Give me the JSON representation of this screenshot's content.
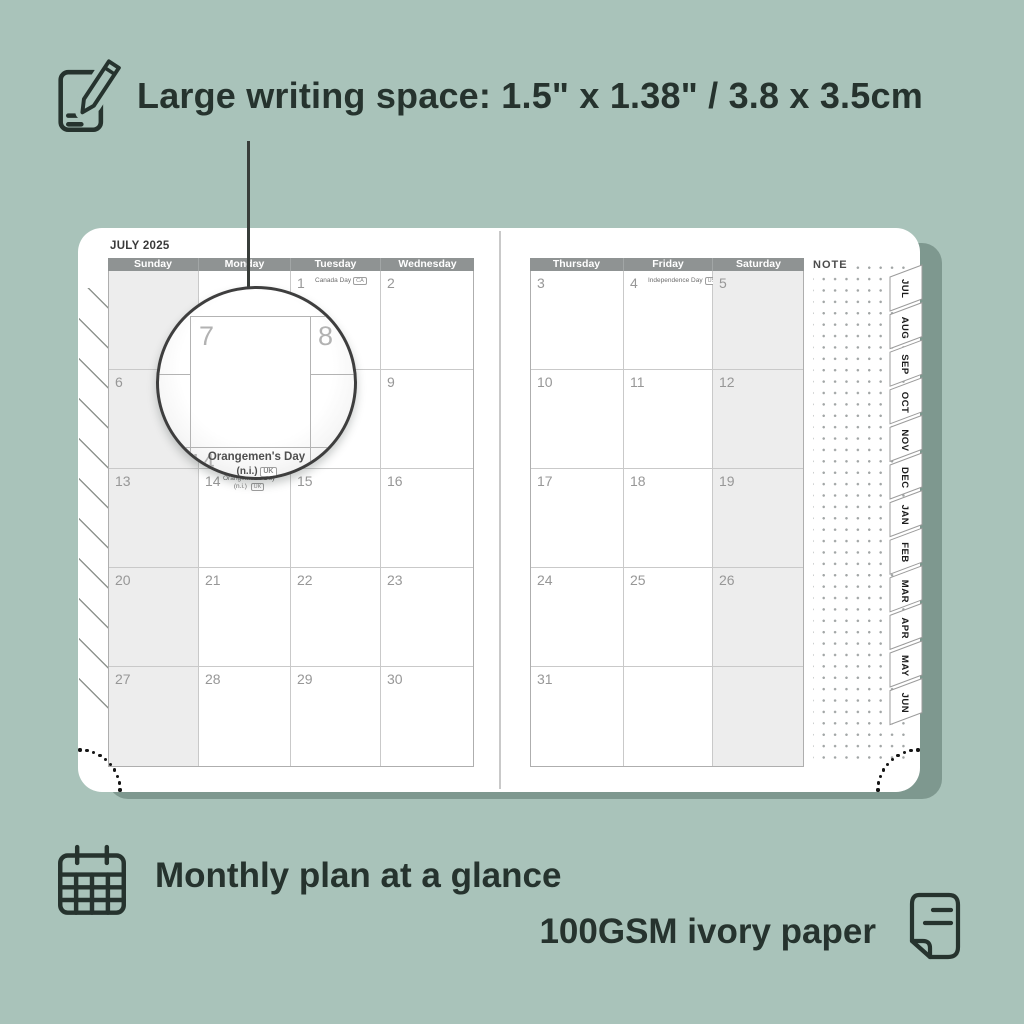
{
  "headline": "Large writing space: 1.5\" x 1.38\" / 3.8 x 3.5cm",
  "planner": {
    "month_title": "JULY 2025",
    "note_label": "NOTE",
    "left_day_headers": [
      "Sunday",
      "Monday",
      "Tuesday",
      "Wednesday"
    ],
    "right_day_headers": [
      "Thursday",
      "Friday",
      "Saturday"
    ],
    "left_rows": [
      [
        {},
        {},
        {
          "day": "1",
          "holiday": "Canada Day",
          "badge": "CA"
        },
        {
          "day": "2"
        }
      ],
      [
        {
          "day": "6"
        },
        {
          "day": "7"
        },
        {
          "day": "8"
        },
        {
          "day": "9"
        }
      ],
      [
        {
          "day": "13"
        },
        {
          "day": "14",
          "holiday": "Orangemen's Day",
          "holiday2": "(n.i.)",
          "badge": "UK"
        },
        {
          "day": "15"
        },
        {
          "day": "16"
        }
      ],
      [
        {
          "day": "20"
        },
        {
          "day": "21"
        },
        {
          "day": "22"
        },
        {
          "day": "23"
        }
      ],
      [
        {
          "day": "27"
        },
        {
          "day": "28"
        },
        {
          "day": "29"
        },
        {
          "day": "30"
        }
      ]
    ],
    "right_rows": [
      [
        {
          "day": "3"
        },
        {
          "day": "4",
          "holiday": "Independence Day",
          "badge": "US"
        },
        {
          "day": "5"
        }
      ],
      [
        {
          "day": "10"
        },
        {
          "day": "11"
        },
        {
          "day": "12"
        }
      ],
      [
        {
          "day": "17"
        },
        {
          "day": "18"
        },
        {
          "day": "19"
        }
      ],
      [
        {
          "day": "24"
        },
        {
          "day": "25"
        },
        {
          "day": "26"
        }
      ],
      [
        {
          "day": "31"
        },
        {},
        {}
      ]
    ],
    "shaded_left_column": "Sunday",
    "shaded_right_column": "Saturday",
    "month_tabs": [
      "JUL",
      "AUG",
      "SEP",
      "OCT",
      "NOV",
      "DEC",
      "JAN",
      "FEB",
      "MAR",
      "APR",
      "MAY",
      "JUN"
    ]
  },
  "magnifier": {
    "day_top_left": "7",
    "day_top_right": "8",
    "day_bottom": "14",
    "holiday": "Orangemen's Day",
    "holiday2": "(n.i.)",
    "badge": "UK"
  },
  "features": [
    {
      "icon": "calendar-grid-icon",
      "label": "Monthly plan at a glance"
    },
    {
      "icon": "paper-icon",
      "label": "100GSM ivory paper"
    }
  ],
  "colors": {
    "background": "#a9c3ba",
    "page": "#ffffff",
    "header_bar": "#8f9393",
    "shaded_column": "#ededed",
    "headline_text": "#26332e",
    "date_number": "#979797",
    "shadow_band": "#5a7268"
  }
}
